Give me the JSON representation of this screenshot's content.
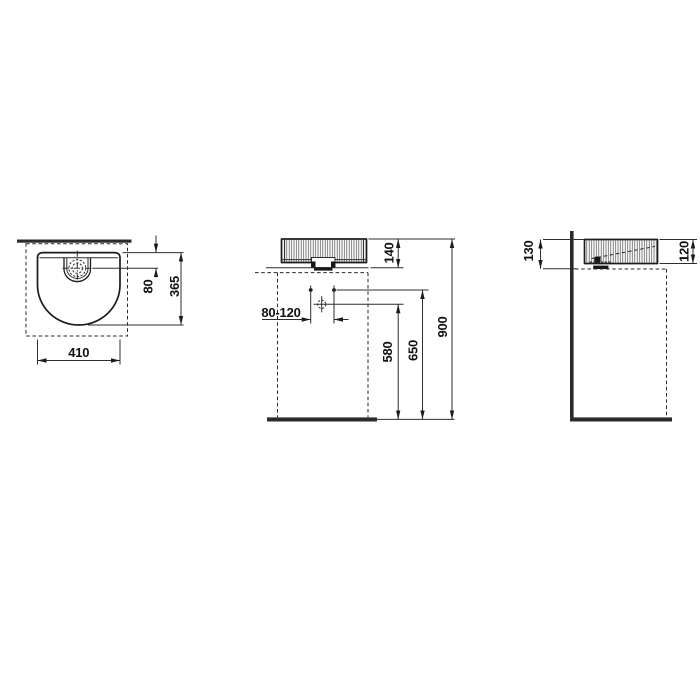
{
  "document": {
    "kind": "sanitary-ware dimension drawing",
    "background_color": "#ffffff",
    "line_color": "#1c1c1c"
  },
  "views": {
    "top_view": {
      "name": "top view",
      "dimensions": [
        {
          "id": "drain-offset-from-rear",
          "label": "80"
        },
        {
          "id": "basin-depth",
          "label": "365"
        },
        {
          "id": "basin-width",
          "label": "410"
        }
      ]
    },
    "front_view": {
      "name": "front view",
      "dimensions": [
        {
          "id": "basin-height",
          "label": "140"
        },
        {
          "id": "fixing-hole-spacing",
          "label": "80-120"
        },
        {
          "id": "drain-outlet-height",
          "label": "580"
        },
        {
          "id": "fixing-holes-height",
          "label": "650"
        },
        {
          "id": "rim-height",
          "label": "900"
        }
      ]
    },
    "side_view": {
      "name": "side view",
      "dimensions": [
        {
          "id": "height-to-counter",
          "label": "130"
        },
        {
          "id": "basin-height",
          "label": "120"
        }
      ]
    }
  }
}
